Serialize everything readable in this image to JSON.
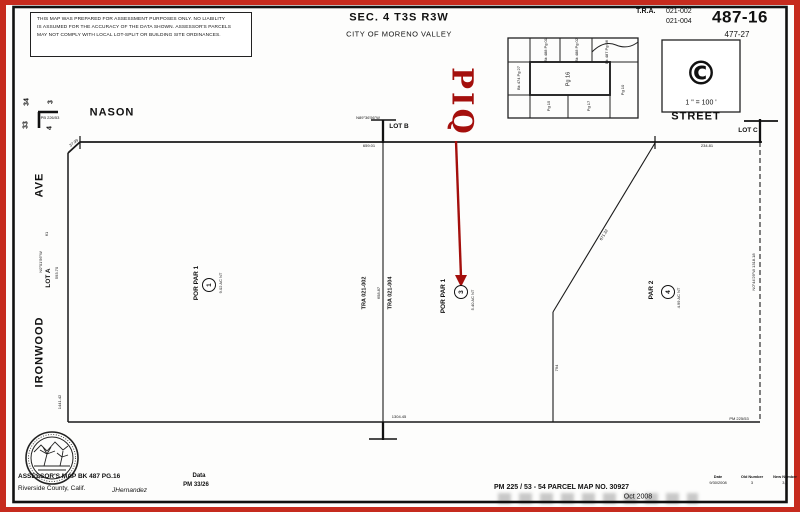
{
  "header": {
    "disclaimer": {
      "line1": "THIS MAP WAS PREPARED FOR ASSESSMENT PURPOSES ONLY.  NO LIABILITY",
      "line2": "IS ASSUMED FOR THE ACCURACY OF THE DATA SHOWN.  ASSESSOR'S PARCELS",
      "line3": "MAY NOT COMPLY WITH LOCAL LOT-SPLIT OR BUILDING SITE ORDINANCES."
    },
    "section_title": "SEC. 4 T3S R3W",
    "city": "CITY OF MORENO VALLEY",
    "tra_label": "T.R.A.",
    "tra_codes": [
      "021-002",
      "021-004"
    ],
    "book_page": "487-16",
    "cross_ref": "477-27"
  },
  "scale_box": {
    "copyright": "©",
    "scale": "1 \" = 100 '"
  },
  "index_map": {
    "cells": [
      "Bk 474 Pg 27",
      "Bk 488 Pg 01",
      "Bk 488 Pg 02",
      "Bk 487 Pg 06",
      "Pg 16",
      "Pg 10",
      "Pg 15",
      "Pg 17"
    ]
  },
  "streets": {
    "north": "NASON",
    "east": "STREET",
    "west": "AVE",
    "south_west": "IRONWOOD"
  },
  "lots": {
    "a": "LOT A",
    "b": "LOT B",
    "c": "LOT C"
  },
  "piq": {
    "label": "PIQ",
    "color": "#a40f0c"
  },
  "parcels": {
    "p1": {
      "name": "POR PAR 1",
      "num": "1",
      "area": "9.02 AC NT"
    },
    "p3": {
      "name": "POR PAR 1",
      "num": "3",
      "area": "5.40 AC NT"
    },
    "p4": {
      "name": "PAR 2",
      "num": "4",
      "area": "4.99 AC NT"
    },
    "tra_left": "TRA  021-002",
    "tra_right": "TRA  021-004"
  },
  "sections": {
    "nw": "34",
    "ne": "3",
    "sw": "33",
    "se": "4",
    "ref": "PB 226/53"
  },
  "dimensions": {
    "top_bearing": "N89°36'56\"W",
    "top_left": "659.01",
    "top_right": "234.81",
    "right_edge": "N0°44'29\"W  1318.18",
    "left_bearing": "N0°01'56\"W",
    "left_mid": "593.70",
    "left_small": "61",
    "left_total": "1441.42",
    "center_line": "658.87",
    "diagonal": "671.32",
    "segment": "794",
    "bottom_mid": "1304.45",
    "chamfer": "37.99",
    "corner_ref": "PM 225/53"
  },
  "footer": {
    "assessor_line1": "ASSESSOR'S MAP BK 487 PG.16",
    "assessor_line2": "Riverside County, Calif.",
    "drafter": "JHernandez",
    "data_label": "Data",
    "data_value": "PM 33/26",
    "map_ref": "PM 225  /  53  -  54  PARCEL MAP NO. 30927",
    "date": "Oct 2008",
    "revision_table": {
      "headers": [
        "Date",
        "Old Number",
        "New Number"
      ],
      "rows": [
        [
          "9/30/2008",
          "3",
          "3,4"
        ]
      ]
    }
  }
}
